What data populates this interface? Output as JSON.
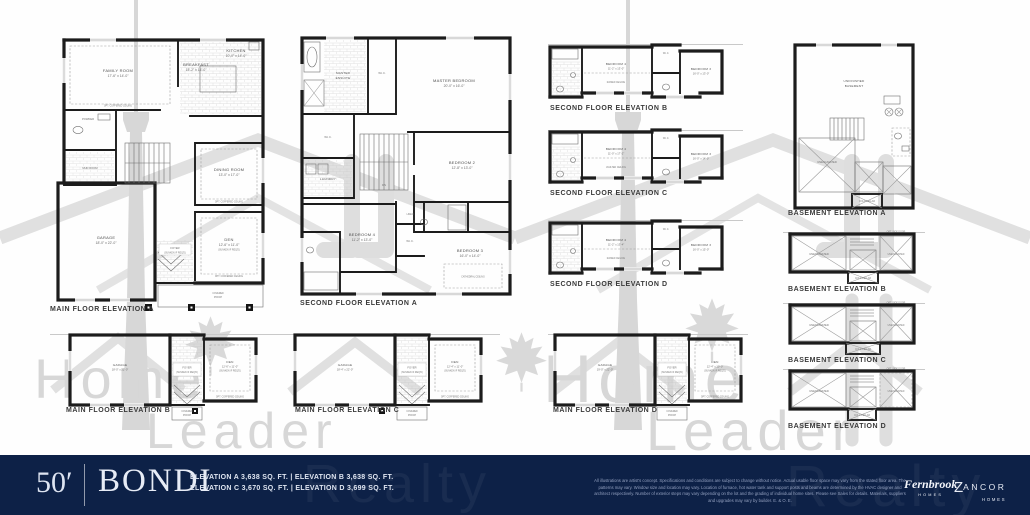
{
  "watermark": {
    "home": "Home",
    "leader": "Leader",
    "realty": "Realty"
  },
  "footer": {
    "lot_width": "50′",
    "model_name": "BONDI",
    "elevation_line1": "ELEVATION A 3,638 SQ. FT.  |  ELEVATION B 3,638 SQ. FT.",
    "elevation_line2": "ELEVATION C 3,670 SQ. FT.  |  ELEVATION D 3,699 SQ. FT.",
    "disclaimer": "All illustrations are artist's concept. Specifications and conditions are subject to change without notice. Actual usable floor space may vary from the stated floor area. The patterns may vary. Window size and location may vary. Location of furnace, hot water tank and support posts and beams are determined by the HVAC designer and architect respectively. Number of exterior steps may vary depending on the lot and the grading of individual home sites. Please see Sales for details. Materials, suppliers and upgrades may vary by builder. E. & O. E.",
    "fernbrook_name": "Fernbrook",
    "fernbrook_sub": "HOMES",
    "zancor_initial": "Z",
    "zancor_rest": "ANCOR",
    "zancor_sub": "HOMES"
  },
  "plans": {
    "main_a": {
      "title": "MAIN FLOOR ELEVATION A",
      "family_name": "FAMILY ROOM",
      "family_dims": "17'-6\" x 14'-0\"",
      "family_note": "OPT. COFFERED CEILING",
      "breakfast_name": "BREAKFAST",
      "breakfast_dims": "15'-2\" x 14'-0\"",
      "kitchen_name": "KITCHEN",
      "kitchen_dims": "10'-0\" x 14'-0\"",
      "powder": "POWDER",
      "mud": "MUD ROOM",
      "dining_name": "DINING ROOM",
      "dining_dims": "13'-0\" x 17'-0\"",
      "dining_note": "OPT. COFFERED CEILING",
      "garage_name": "GARAGE",
      "garage_dims": "18'-0\" x 22'-0\"",
      "foyer": "FOYER",
      "foyer_note": "(SUNKEN IF REQ'D)",
      "den_name": "DEN",
      "den_dims": "12'-6\" x 11'-0\"",
      "den_note": "(SUNKEN IF REQ'D)",
      "den_ceiling": "OPT. COFFERED CEILING",
      "porch_line1": "COVERED",
      "porch_line2": "PORCH"
    },
    "second_a": {
      "title": "SECOND FLOOR ELEVATION A",
      "master_name": "MASTER BEDROOM",
      "master_dims": "20'-0\" x 16'-0\"",
      "ensuite_line1": "MASTER",
      "ensuite_line2": "ENSUITE",
      "wic1": "W.I.C.",
      "wic2": "W.I.C.",
      "wic3": "W.I.C.",
      "laundry": "LAUNDRY",
      "linen": "LINEN",
      "dn": "DN",
      "bed2_name": "BEDROOM 2",
      "bed2_dims": "12'-8\" x 13'-0\"",
      "bed3_name": "BEDROOM 3",
      "bed3_dims": "16'-0\" x 14'-0\"",
      "bed4_name": "BEDROOM 4",
      "bed4_dims": "11'-2\" x 13'-0\"",
      "cathedral": "CATHEDRAL CEILING"
    },
    "second_b": {
      "title": "SECOND FLOOR ELEVATION B",
      "bed4_name": "BEDROOM 4",
      "bed4_dims": "11'-2\" x 13'-0\"",
      "bed4_note": "RAISED CEILING",
      "bed3_name": "BEDROOM 3",
      "bed3_dims": "16'-0\" x 13'-0\"",
      "wic": "W.I.C."
    },
    "second_c": {
      "title": "SECOND FLOOR ELEVATION C",
      "bed4_name": "BEDROOM 4",
      "bed4_dims": "11'-0\" x 17'-2\"",
      "bed4_note": "VAULTED CEILING",
      "bed3_name": "BEDROOM 3",
      "bed3_dims": "16'-0\" x 14'-0\"",
      "wic": "W.I.C."
    },
    "second_d": {
      "title": "SECOND FLOOR ELEVATION D",
      "bed4_name": "BEDROOM 4",
      "bed4_dims": "11'-2\" x 13'-4\"",
      "bed4_note": "RAISED CEILING",
      "bed3_name": "BEDROOM 3",
      "bed3_dims": "16'-0\" x 15'-0\"",
      "wic": "W.I.C."
    },
    "basement_a": {
      "title": "BASEMENT ELEVATION A",
      "unfinished_line1": "UNFINISHED",
      "unfinished_line2": "BASEMENT",
      "unexcavated": "UNEXCAVATED",
      "cold_cellar": "COLD CELLAR"
    },
    "basement_b": {
      "title": "BASEMENT ELEVATION B",
      "unexcavated_left": "UNEXCAVATED",
      "unexcavated_right": "UNEXCAVATED",
      "cold_cellar": "COLD CELLAR",
      "note": "OPT. SIDE DOOR"
    },
    "basement_c": {
      "title": "BASEMENT ELEVATION C",
      "unexcavated_left": "UNEXCAVATED",
      "unexcavated_right": "UNEXCAVATED",
      "cold_cellar": "COLD CELLAR",
      "note": "OPT. SIDE DOOR"
    },
    "basement_d": {
      "title": "BASEMENT ELEVATION D",
      "unexcavated_left": "UNEXCAVATED",
      "unexcavated_right": "UNEXCAVATED",
      "cold_cellar": "COLD CELLAR",
      "note": "OPT. SIDE DOOR"
    },
    "main_b": {
      "title": "MAIN FLOOR ELEVATION B",
      "garage_name": "GARAGE",
      "garage_dims": "18'-0\" x 22'-0\"",
      "foyer": "FOYER",
      "foyer_note": "(SUNKEN IF REQ'D)",
      "den_name": "DEN",
      "den_dims": "12'-6\" x 11'-0\"",
      "den_note": "(SUNKEN IF REQ'D)",
      "den_ceiling": "OPT. COFFERED CEILING",
      "porch_line1": "COVERED",
      "porch_line2": "PORCH"
    },
    "main_c": {
      "title": "MAIN FLOOR ELEVATION C",
      "garage_name": "GARAGE",
      "garage_dims": "18'-4\" x 22'-0\"",
      "foyer": "FOYER",
      "foyer_note": "(SUNKEN IF REQ'D)",
      "den_name": "DEN",
      "den_dims": "12'-4\" x 11'-0\"",
      "den_note": "(SUNKEN IF REQ'D)",
      "den_ceiling": "OPT. COFFERED CEILING",
      "porch_line1": "COVERED",
      "porch_line2": "PORCH"
    },
    "main_d": {
      "title": "MAIN FLOOR ELEVATION D",
      "garage_name": "GARAGE",
      "garage_dims": "19'-0\" x 22'-0\"",
      "foyer": "FOYER",
      "foyer_note": "(SUNKEN IF REQ'D)",
      "den_name": "DEN",
      "den_dims": "12'-4\" x 10'-0\"",
      "den_note": "(SUNKEN IF REQ'D)",
      "den_ceiling": "OPT. COFFERED CEILING",
      "porch_line1": "COVERED",
      "porch_line2": "PORCH"
    }
  }
}
